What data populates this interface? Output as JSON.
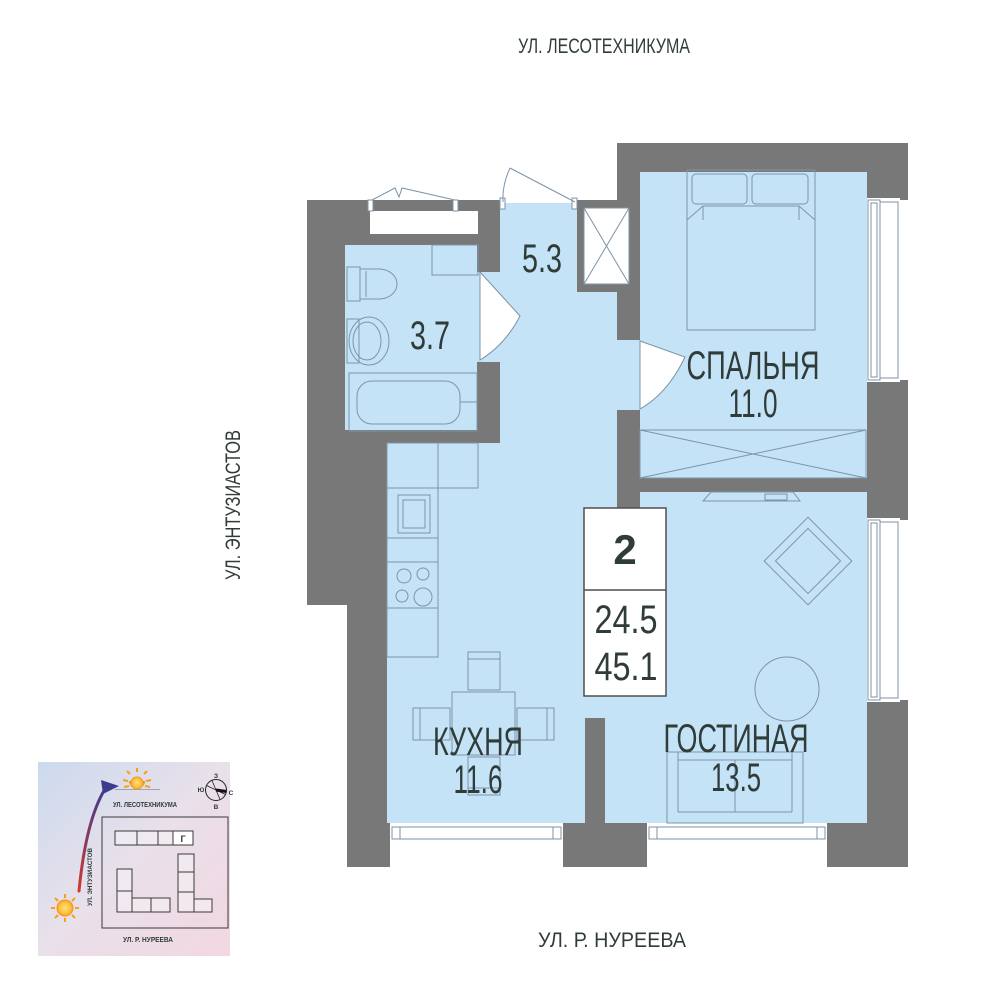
{
  "streets": {
    "top": "УЛ. ЛЕСОТЕХНИКУМА",
    "left": "УЛ. ЭНТУЗИАСТОВ",
    "bottom": "УЛ. Р. НУРЕЕВА"
  },
  "unit": {
    "rooms_count": "2",
    "area_living": "24.5",
    "area_total": "45.1"
  },
  "rooms": {
    "bedroom": {
      "name": "СПАЛЬНЯ",
      "area": "11.0"
    },
    "kitchen": {
      "name": "КУХНЯ",
      "area": "11.6"
    },
    "living": {
      "name": "ГОСТИНАЯ",
      "area": "13.5"
    },
    "hall": {
      "area": "5.3"
    },
    "bath": {
      "area": "3.7"
    }
  },
  "minimap": {
    "street_top": "УЛ. ЛЕСОТЕХНИКУМА",
    "street_left": "УЛ. ЭНТУЗИАСТОВ",
    "street_bottom": "УЛ. Р. НУРЕЕВА",
    "building_label": "Г",
    "compass": {
      "top": "З",
      "left": "Ю",
      "right": "С",
      "bottom": "В"
    }
  },
  "colors": {
    "wall": "#787878",
    "floor": "#c5e3f7",
    "line": "#7d93a8",
    "text": "#303c3a",
    "sun": "#f5a01c",
    "arrow_start": "#cf3a30",
    "arrow_end": "#3d3b8e"
  }
}
